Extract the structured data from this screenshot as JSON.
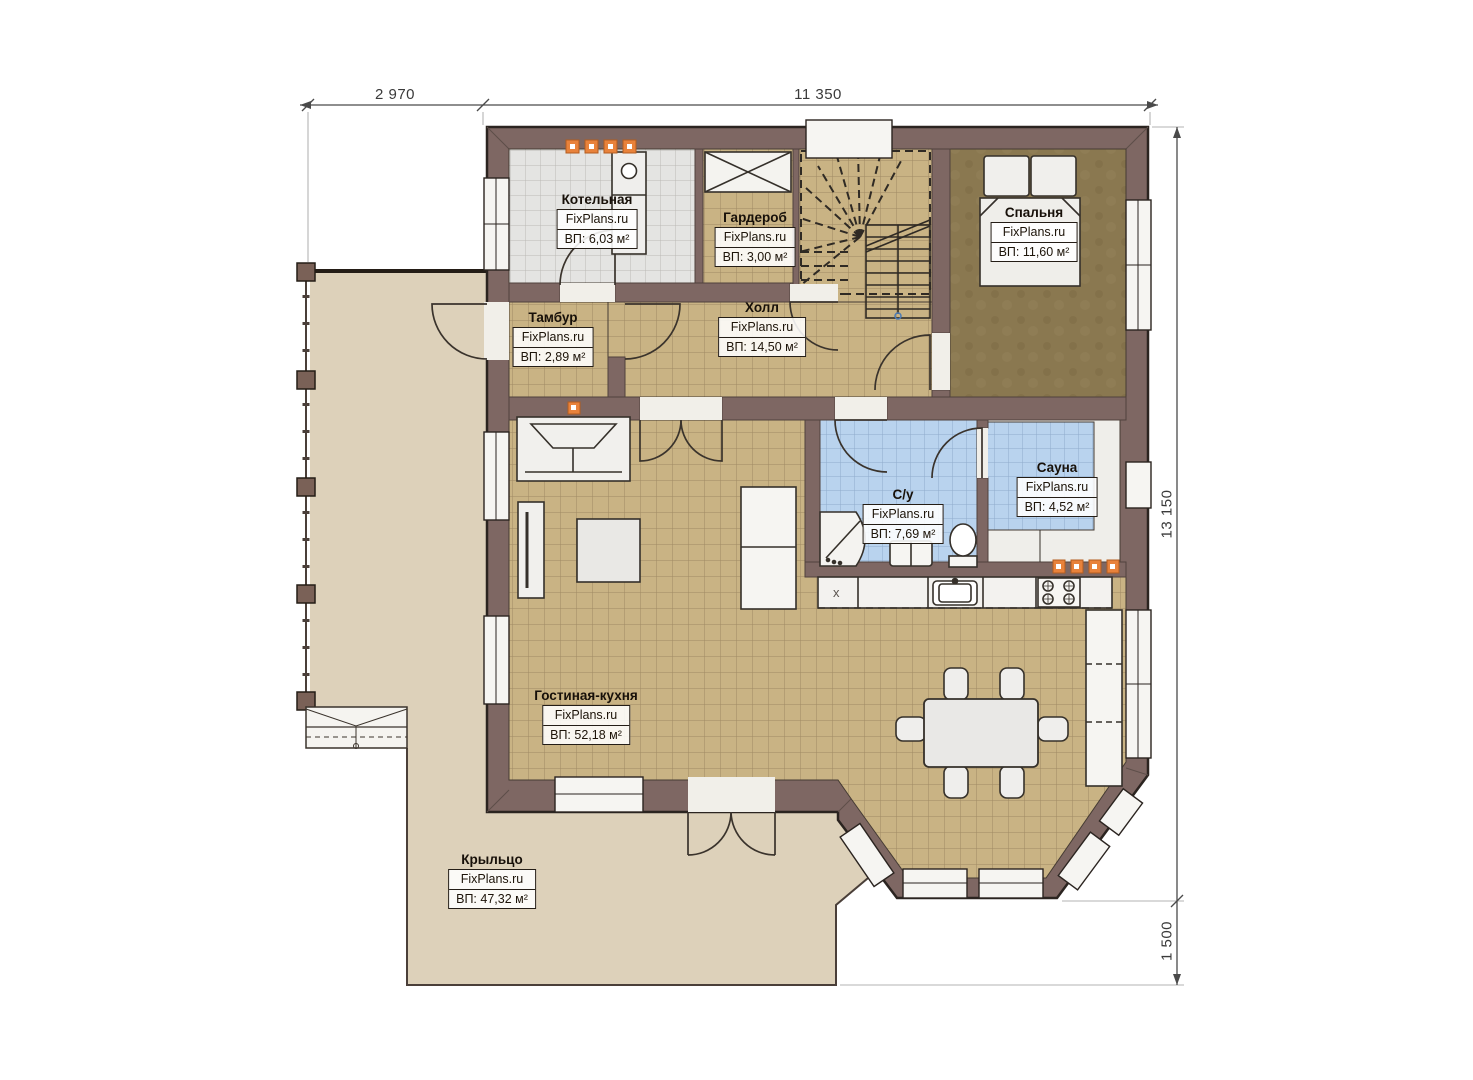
{
  "watermark": "FixPlans.ru",
  "dimensions": {
    "top_left": "2 970",
    "top_right": "11 350",
    "right": "13 150",
    "right_bottom": "1 500"
  },
  "markers": {
    "dishwasher": "x"
  },
  "rooms": [
    {
      "name": "Котельная",
      "area_label": "ВП: 6,03 м²"
    },
    {
      "name": "Гардероб",
      "area_label": "ВП: 3,00 м²"
    },
    {
      "name": "Спальня",
      "area_label": "ВП: 11,60 м²"
    },
    {
      "name": "Тамбур",
      "area_label": "ВП: 2,89 м²"
    },
    {
      "name": "Холл",
      "area_label": "ВП: 14,50 м²"
    },
    {
      "name": "С/у",
      "area_label": "ВП: 7,69 м²"
    },
    {
      "name": "Сауна",
      "area_label": "ВП: 4,52 м²"
    },
    {
      "name": "Гостиная-кухня",
      "area_label": "ВП: 52,18 м²"
    },
    {
      "name": "Крыльцо",
      "area_label": "ВП: 47,32 м²"
    }
  ],
  "colors": {
    "wall": "#7e6763",
    "floor_tile": "#c9b384",
    "bedroom_floor": "#8a7850",
    "wet_tile": "#b9d3ee",
    "boiler_tile": "#e4e4e2",
    "porch_floor": "#ddd1ba",
    "radiator": "#e8823b"
  }
}
